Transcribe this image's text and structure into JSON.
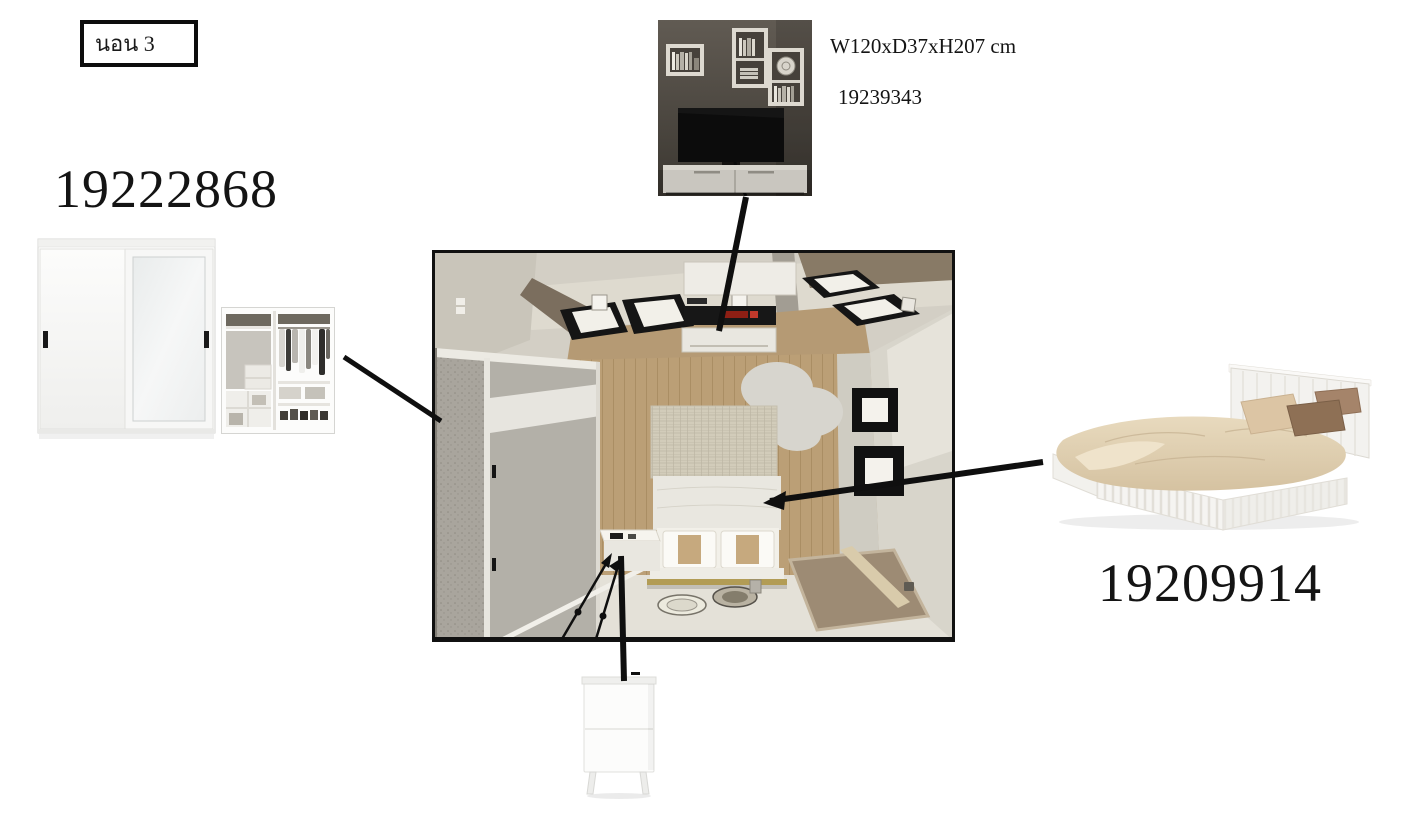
{
  "room_label": {
    "text": "นอน 3"
  },
  "products": {
    "wardrobe": {
      "id": "19222868"
    },
    "tv_wall_unit": {
      "dimensions": "W120xD37xH207 cm",
      "id": "19239343"
    },
    "bed": {
      "id": "19209914"
    }
  },
  "colors": {
    "connector_line": "#0f0f0f",
    "text": "#141414",
    "plan_border": "#111111",
    "wood_floor": "#bb9f76",
    "wall": "#d3cfc5"
  }
}
